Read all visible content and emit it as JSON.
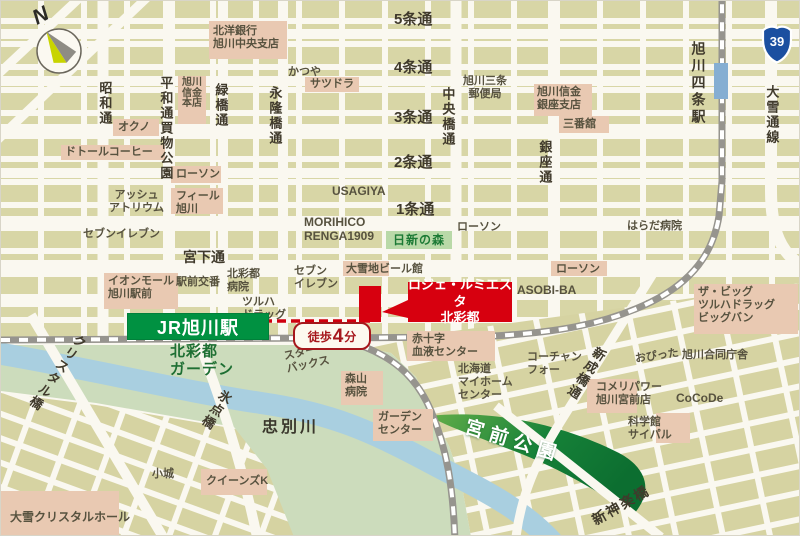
{
  "map": {
    "compass_label": "N",
    "route_shield": "39",
    "station_banner": "JR旭川駅",
    "walk_badge": {
      "prefix": "徒歩",
      "number": "4",
      "suffix": "分"
    },
    "property": {
      "line1": "ロジェ・ルミエスタ",
      "line2": "北彩都"
    }
  },
  "colors": {
    "accent_red": "#d7000f",
    "jr_green": "#009141",
    "park_green": "#0f7a36",
    "block_khaki": "#d8d6a6",
    "landmark_pink": "#e9c9b2",
    "river_blue": "#a9cfe0",
    "rail_gray": "#96948e",
    "route_blue": "#1b4fa0"
  },
  "labels": [
    {
      "n": "street-showa-dori",
      "t": "昭和通",
      "x": 96,
      "y": 80,
      "c": "sv"
    },
    {
      "n": "street-heiwadori-kaimono-koen",
      "t": "平和通買物公園",
      "x": 157,
      "y": 75,
      "c": "sv"
    },
    {
      "n": "street-midoribashi-dori",
      "t": "緑橋通",
      "x": 212,
      "y": 82,
      "c": "sv"
    },
    {
      "n": "street-eiryubashi-dori",
      "t": "永隆橋通",
      "x": 266,
      "y": 85,
      "c": "sv"
    },
    {
      "n": "street-chuobashi-dori",
      "t": "中央橋通",
      "x": 439,
      "y": 86,
      "c": "sv"
    },
    {
      "n": "street-ginza-dori",
      "t": "銀座通",
      "x": 536,
      "y": 139,
      "c": "sv"
    },
    {
      "n": "station-asahikawa-yojo",
      "t": "旭川四条駅",
      "x": 689,
      "y": 40,
      "c": "sv2"
    },
    {
      "n": "street-taisetsu-dori-line",
      "t": "大雪通線",
      "x": 763,
      "y": 84,
      "c": "sv"
    },
    {
      "n": "street-5jo-dori",
      "t": "5条通",
      "x": 393,
      "y": 10,
      "c": "sh"
    },
    {
      "n": "street-4jo-dori",
      "t": "4条通",
      "x": 393,
      "y": 58,
      "c": "sh"
    },
    {
      "n": "street-3jo-dori",
      "t": "3条通",
      "x": 393,
      "y": 108,
      "c": "sh"
    },
    {
      "n": "street-2jo-dori",
      "t": "2条通",
      "x": 393,
      "y": 153,
      "c": "sh"
    },
    {
      "n": "street-1jo-dori",
      "t": "1条通",
      "x": 395,
      "y": 200,
      "c": "sh"
    },
    {
      "n": "street-miyashita-dori",
      "t": "宮下通",
      "x": 182,
      "y": 248,
      "c": "shs"
    },
    {
      "n": "bridge-crystal",
      "t": "クリスタル橋",
      "x": 48,
      "y": 326,
      "c": "sv",
      "r": 35
    },
    {
      "n": "bridge-hyoten",
      "t": "氷点橋",
      "x": 207,
      "y": 386,
      "c": "sv",
      "r": 33
    },
    {
      "n": "street-shinseibashi-dori",
      "t": "新成橋通",
      "x": 577,
      "y": 342,
      "c": "sv",
      "r": 33
    },
    {
      "n": "bridge-shinkagura",
      "t": "新神楽橋",
      "x": 588,
      "y": 496,
      "c": "sh2",
      "r": -30
    },
    {
      "n": "poi-hokuyo-bank",
      "t": "北洋銀行\n旭川中央支店",
      "x": 212,
      "y": 24,
      "c": "p"
    },
    {
      "n": "poi-katsuya",
      "t": "かつや",
      "x": 287,
      "y": 65,
      "c": "p"
    },
    {
      "n": "poi-satsudora",
      "t": "サツドラ",
      "x": 309,
      "y": 77,
      "c": "p"
    },
    {
      "n": "poi-okuno",
      "t": "オクノ",
      "x": 117,
      "y": 120,
      "c": "p"
    },
    {
      "n": "poi-doutor-coffee",
      "t": "ドトールコーヒー",
      "x": 64,
      "y": 145,
      "c": "p"
    },
    {
      "n": "poi-lawson-1",
      "t": "ローソン",
      "x": 175,
      "y": 167,
      "c": "p"
    },
    {
      "n": "poi-ash-atrium",
      "t": "アッシュ\nアトリウム",
      "x": 108,
      "y": 188,
      "c": "p pc"
    },
    {
      "n": "poi-feeeal-asahikawa",
      "t": "フィール\n旭川",
      "x": 175,
      "y": 189,
      "c": "p"
    },
    {
      "n": "poi-seven-eleven-1",
      "t": "セブンイレブン",
      "x": 82,
      "y": 227,
      "c": "p"
    },
    {
      "n": "poi-asahikawa-shinkin-honten",
      "t": "旭川\n信金\n本店",
      "x": 181,
      "y": 77,
      "c": "ps"
    },
    {
      "n": "poi-asahikawa-sanjo-post",
      "t": "旭川三条\n郵便局",
      "x": 462,
      "y": 74,
      "c": "p pc"
    },
    {
      "n": "poi-asahikawa-shinkin-ginza",
      "t": "旭川信金\n銀座支店",
      "x": 536,
      "y": 85,
      "c": "p"
    },
    {
      "n": "poi-sanbankan",
      "t": "三番舘",
      "x": 562,
      "y": 117,
      "c": "p"
    },
    {
      "n": "poi-usagiya",
      "t": "USAGIYA",
      "x": 331,
      "y": 183,
      "c": "p pl"
    },
    {
      "n": "poi-morihico-renga1909",
      "t": "MORIHICO\nRENGA1909",
      "x": 303,
      "y": 214,
      "c": "p pl"
    },
    {
      "n": "poi-lawson-2",
      "t": "ローソン",
      "x": 456,
      "y": 220,
      "c": "p"
    },
    {
      "n": "poi-harada-hospital",
      "t": "はらだ病院",
      "x": 626,
      "y": 219,
      "c": "p"
    },
    {
      "n": "poi-lawson-3",
      "t": "ローソン",
      "x": 555,
      "y": 262,
      "c": "p"
    },
    {
      "n": "poi-asobi-ba",
      "t": "ASOBI-BA",
      "x": 516,
      "y": 282,
      "c": "p pl"
    },
    {
      "n": "poi-the-big-tsuruha-bigbang",
      "t": "ザ・ビッグ\nツルハドラッグ\nビッグバン",
      "x": 697,
      "y": 285,
      "c": "p"
    },
    {
      "n": "poi-taisetsu-ji-beer-kan",
      "t": "大雪地ビール館",
      "x": 345,
      "y": 262,
      "c": "p"
    },
    {
      "n": "poi-seven-eleven-2",
      "t": "セブン\nイレブン",
      "x": 293,
      "y": 264,
      "c": "p"
    },
    {
      "n": "poi-aeon-mall-asahikawa-ekimae",
      "t": "イオンモール\n旭川駅前",
      "x": 107,
      "y": 274,
      "c": "p"
    },
    {
      "n": "poi-ekimae-koban",
      "t": "駅前交番",
      "x": 175,
      "y": 275,
      "c": "p"
    },
    {
      "n": "poi-kitasaito-hospital",
      "t": "北彩都\n病院",
      "x": 226,
      "y": 267,
      "c": "p"
    },
    {
      "n": "poi-tsuruha-drug",
      "t": "ツルハ\nドラッグ",
      "x": 241,
      "y": 295,
      "c": "p"
    },
    {
      "n": "poi-starbucks",
      "t": "スター\nバックス",
      "x": 284,
      "y": 345,
      "c": "p",
      "r": -12
    },
    {
      "n": "poi-redcross-blood-center",
      "t": "赤十字\n血液センター",
      "x": 411,
      "y": 332,
      "c": "p"
    },
    {
      "n": "poi-hokkaido-myhome-center",
      "t": "北海道\nマイホーム\nセンター",
      "x": 457,
      "y": 362,
      "c": "p"
    },
    {
      "n": "poi-coach-and-four",
      "t": "コーチャン\nフォー",
      "x": 526,
      "y": 350,
      "c": "p"
    },
    {
      "n": "poi-moriyama-hospital",
      "t": "森山\n病院",
      "x": 344,
      "y": 372,
      "c": "p"
    },
    {
      "n": "poi-garden-center",
      "t": "ガーデン\nセンター",
      "x": 377,
      "y": 410,
      "c": "p"
    },
    {
      "n": "poi-opitta",
      "t": "おぴった",
      "x": 634,
      "y": 349,
      "c": "p",
      "r": -8
    },
    {
      "n": "poi-asahikawa-godochosha",
      "t": "旭川合同庁舎",
      "x": 681,
      "y": 348,
      "c": "p"
    },
    {
      "n": "poi-komeri-power-miyamae",
      "t": "コメリパワー\n旭川宮前店",
      "x": 595,
      "y": 380,
      "c": "p"
    },
    {
      "n": "poi-cocode",
      "t": "CoCoDe",
      "x": 675,
      "y": 390,
      "c": "p pl"
    },
    {
      "n": "poi-kagakukan-sci-pal",
      "t": "科学館\nサイパル",
      "x": 627,
      "y": 415,
      "c": "p"
    },
    {
      "n": "poi-kojo",
      "t": "小城",
      "x": 151,
      "y": 467,
      "c": "p"
    },
    {
      "n": "poi-queens-k",
      "t": "クイーンズK",
      "x": 205,
      "y": 474,
      "c": "p"
    },
    {
      "n": "poi-taisetsu-crystal-hall",
      "t": "大雪クリスタルホール",
      "x": 9,
      "y": 509,
      "c": "p pl"
    },
    {
      "n": "area-kitasaito-garden",
      "t": "北彩都\nガーデン",
      "x": 169,
      "y": 342,
      "c": "glabel"
    },
    {
      "n": "river-chubetsu",
      "t": "忠別川",
      "x": 261,
      "y": 418,
      "c": "river"
    },
    {
      "n": "area-nisshin-no-mori",
      "t": "日新の森",
      "x": 385,
      "y": 230,
      "c": "forest"
    },
    {
      "n": "park-miyamae",
      "t": "宮前公園",
      "x": 462,
      "y": 430,
      "c": "park",
      "r": 17
    }
  ]
}
